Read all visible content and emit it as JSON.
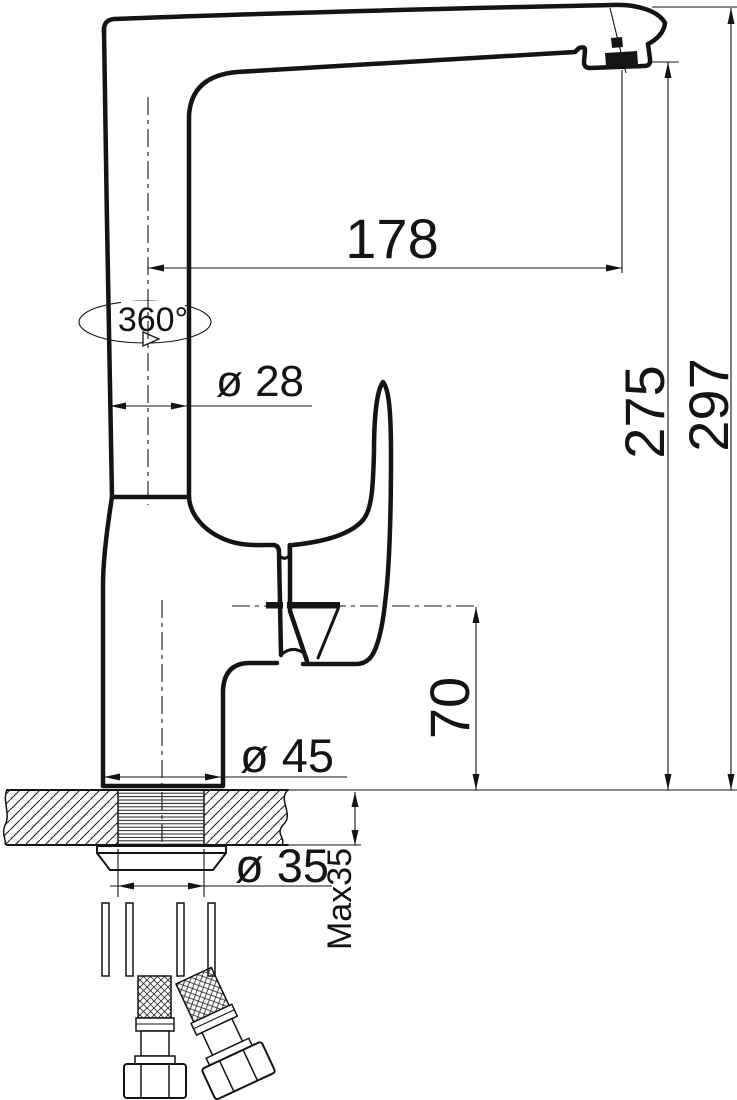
{
  "drawing": {
    "background_color": "#ffffff",
    "line_color": "#141414",
    "dimensions": {
      "spout_reach": "178",
      "swivel_angle": "360°",
      "column_diameter": "ø 28",
      "spout_outlet_height": "275",
      "overall_height": "297",
      "body_height": "70",
      "base_diameter": "ø 45",
      "tailpiece_diameter": "ø 35",
      "max_deck_thickness": "Max35"
    }
  }
}
